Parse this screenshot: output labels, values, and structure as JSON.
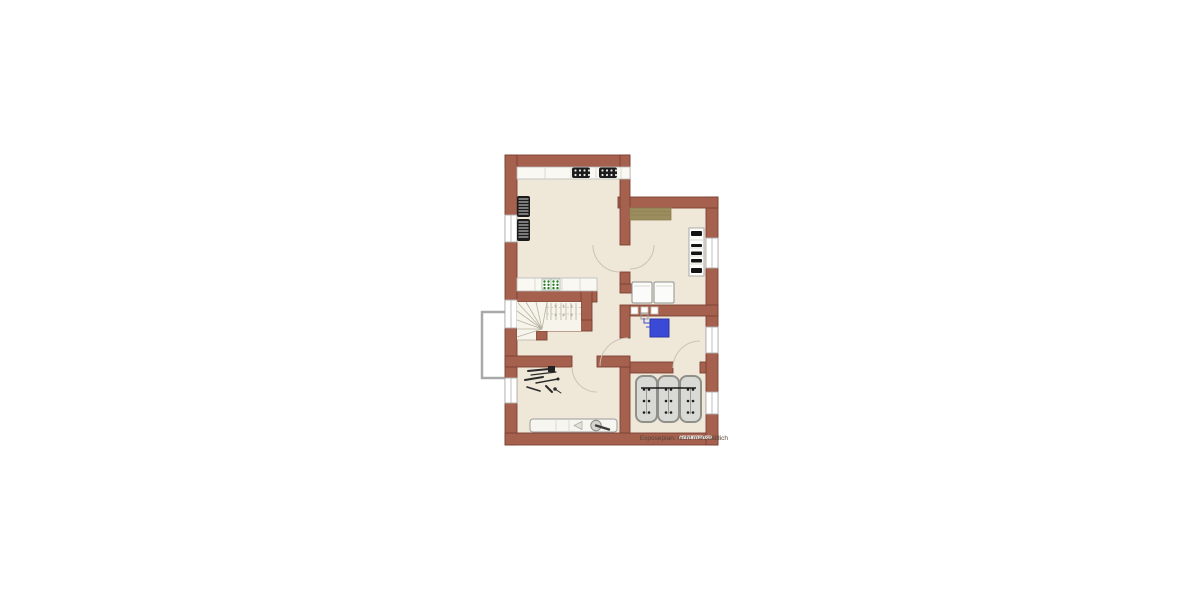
{
  "caption": "Exposeplan, nicht maßstäblich",
  "colors": {
    "background": "#ffffff",
    "wall": "#a5614d",
    "wall_outline": "#7d4233",
    "floor": "#efe8d9",
    "boiler_blue": "#3a49d6",
    "rug_tan": "#9c8d5e",
    "hob_green": "#2f7d28",
    "tank_gray": "#d9d9d5"
  },
  "symbols": {
    "kitchen_hobs": 2,
    "radiators": 2,
    "green_sink_unit": 1,
    "staircase": 1,
    "washing_machines": 2,
    "glass_blocks": 3,
    "boiler": 1,
    "oil_tanks": 3,
    "windows": 6,
    "door_arcs": 5,
    "tool_set": 1,
    "workbench": 1,
    "shelf": 1,
    "rug": 1,
    "light_shaft": 1
  }
}
